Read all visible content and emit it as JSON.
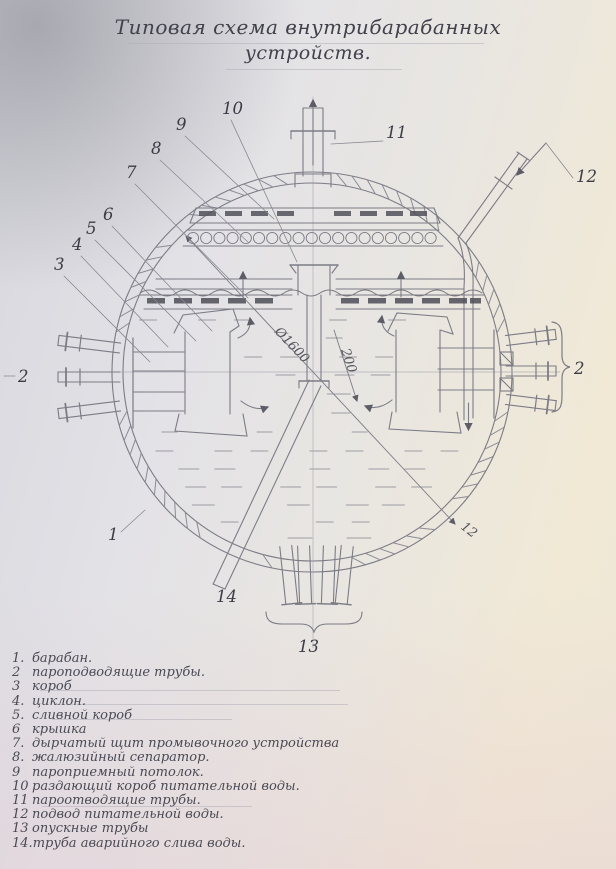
{
  "title": {
    "line1": "Типовая схема внутрибарабанных",
    "line2": "устройств."
  },
  "diagram": {
    "callouts": {
      "c1": "1",
      "c2_left": "2",
      "c2_right": "2",
      "c3": "3",
      "c4": "4",
      "c5": "5",
      "c6": "6",
      "c7": "7",
      "c8": "8",
      "c9": "9",
      "c10": "10",
      "c11": "11",
      "c12": "12",
      "c12_dim": "12",
      "c13": "13",
      "c14": "14"
    },
    "dimensions": {
      "drum_diameter": "Ø1600",
      "water_level_offset": "200"
    }
  },
  "legend": {
    "items": [
      {
        "num": "1.",
        "text": "барабан."
      },
      {
        "num": "2",
        "text": "пароподводящие трубы."
      },
      {
        "num": "3",
        "text": "короб"
      },
      {
        "num": "4.",
        "text": "циклон."
      },
      {
        "num": "5.",
        "text": "сливной короб"
      },
      {
        "num": "6",
        "text": "крышка"
      },
      {
        "num": "7.",
        "text": "дырчатый щит промывочного устройства"
      },
      {
        "num": "8.",
        "text": "жалюзийный сепаратор."
      },
      {
        "num": "9",
        "text": "пароприемный потолок."
      },
      {
        "num": "10",
        "text": "раздающий короб питательной воды."
      },
      {
        "num": "11",
        "text": "пароотводящие трубы."
      },
      {
        "num": "12",
        "text": "подвод питательной воды."
      },
      {
        "num": "13",
        "text": "опускные трубы"
      },
      {
        "num": "14.",
        "text": "труба аварийного слива воды."
      }
    ]
  }
}
